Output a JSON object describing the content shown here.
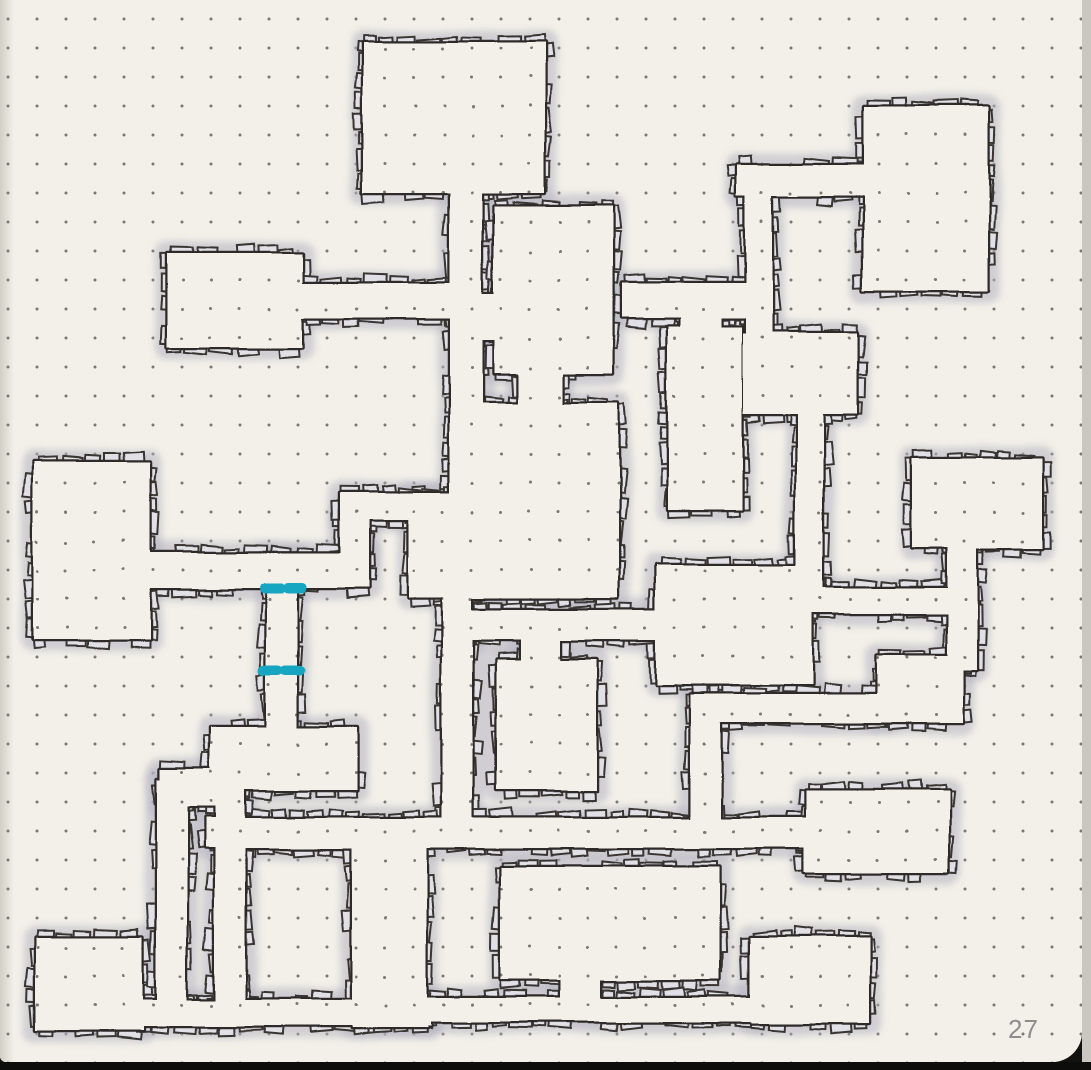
{
  "page": {
    "number": "27"
  },
  "palette": {
    "paper": "#f2f0e8",
    "dot": "#63625d",
    "ink": "#2e2c29",
    "brick_fill": "#e1e0e6",
    "brick_stroke": "#393631",
    "glow": "#b5b3c1",
    "teal_door": "#15a6c2",
    "page_number_color": "#8d8d8d"
  },
  "grid": {
    "spacing": 29,
    "offset_x": 8,
    "offset_y": 19,
    "dot_radius": 1.5
  },
  "map": {
    "shapes": [
      {
        "name": "room-top-mid",
        "x": 363,
        "y": 42,
        "w": 182,
        "h": 152
      },
      {
        "name": "corr-top-vertical",
        "x": 450,
        "y": 180,
        "w": 32,
        "h": 325
      },
      {
        "name": "room-top-left",
        "x": 167,
        "y": 253,
        "w": 135,
        "h": 95
      },
      {
        "name": "corr-topleft-east",
        "x": 290,
        "y": 283,
        "w": 172,
        "h": 35
      },
      {
        "name": "room-center-top",
        "x": 494,
        "y": 207,
        "w": 119,
        "h": 166
      },
      {
        "name": "conn-vert-centertop",
        "x": 470,
        "y": 295,
        "w": 36,
        "h": 45
      },
      {
        "name": "conn-centertop-center",
        "x": 518,
        "y": 360,
        "w": 44,
        "h": 55
      },
      {
        "name": "room-center-east",
        "x": 478,
        "y": 403,
        "w": 140,
        "h": 195
      },
      {
        "name": "room-center-west",
        "x": 408,
        "y": 493,
        "w": 80,
        "h": 105
      },
      {
        "name": "corr-west-east",
        "x": 138,
        "y": 553,
        "w": 230,
        "h": 35
      },
      {
        "name": "conn-west-jog",
        "x": 340,
        "y": 510,
        "w": 28,
        "h": 55
      },
      {
        "name": "corr-west-upper",
        "x": 340,
        "y": 493,
        "w": 142,
        "h": 27
      },
      {
        "name": "room-left-big",
        "x": 33,
        "y": 462,
        "w": 117,
        "h": 178
      },
      {
        "name": "corr-teal-vertical",
        "x": 266,
        "y": 553,
        "w": 32,
        "h": 187
      },
      {
        "name": "room-lowerleft-small",
        "x": 210,
        "y": 728,
        "w": 147,
        "h": 62
      },
      {
        "name": "room-top-right",
        "x": 863,
        "y": 107,
        "w": 125,
        "h": 184
      },
      {
        "name": "corr-hook-horizontal",
        "x": 737,
        "y": 165,
        "w": 140,
        "h": 31
      },
      {
        "name": "corr-hook-vertical",
        "x": 746,
        "y": 190,
        "w": 26,
        "h": 155
      },
      {
        "name": "room-inner-topright",
        "x": 743,
        "y": 333,
        "w": 114,
        "h": 81
      },
      {
        "name": "room-tall-midright",
        "x": 668,
        "y": 327,
        "w": 74,
        "h": 183
      },
      {
        "name": "corr-right-horizontal",
        "x": 622,
        "y": 283,
        "w": 138,
        "h": 35
      },
      {
        "name": "conn-tall-top",
        "x": 680,
        "y": 300,
        "w": 42,
        "h": 45
      },
      {
        "name": "room-midlow-center",
        "x": 656,
        "y": 565,
        "w": 156,
        "h": 120
      },
      {
        "name": "corr-mid-horizontal",
        "x": 455,
        "y": 610,
        "w": 215,
        "h": 30
      },
      {
        "name": "corr-center-down",
        "x": 443,
        "y": 585,
        "w": 30,
        "h": 245
      },
      {
        "name": "room-lowercenter-small",
        "x": 497,
        "y": 660,
        "w": 100,
        "h": 130
      },
      {
        "name": "conn-r15-top",
        "x": 520,
        "y": 632,
        "w": 40,
        "h": 40
      },
      {
        "name": "corr-long-h1",
        "x": 205,
        "y": 818,
        "w": 610,
        "h": 30
      },
      {
        "name": "corr-inner-down",
        "x": 797,
        "y": 405,
        "w": 26,
        "h": 195
      },
      {
        "name": "corr-east-horizontal",
        "x": 805,
        "y": 588,
        "w": 165,
        "h": 25
      },
      {
        "name": "corr-midright-down",
        "x": 948,
        "y": 540,
        "w": 29,
        "h": 130
      },
      {
        "name": "room-mid-right",
        "x": 912,
        "y": 458,
        "w": 130,
        "h": 90
      },
      {
        "name": "room-right-small",
        "x": 877,
        "y": 655,
        "w": 86,
        "h": 68
      },
      {
        "name": "corr-right-strip",
        "x": 700,
        "y": 695,
        "w": 190,
        "h": 28
      },
      {
        "name": "conn-strip-down",
        "x": 690,
        "y": 695,
        "w": 30,
        "h": 140
      },
      {
        "name": "room-east-long",
        "x": 805,
        "y": 790,
        "w": 143,
        "h": 83
      },
      {
        "name": "room-bottom-center",
        "x": 500,
        "y": 867,
        "w": 220,
        "h": 113
      },
      {
        "name": "conn-r12-down",
        "x": 560,
        "y": 960,
        "w": 40,
        "h": 55
      },
      {
        "name": "corr-bottom-h2",
        "x": 420,
        "y": 998,
        "w": 337,
        "h": 24
      },
      {
        "name": "room-bottom-right",
        "x": 750,
        "y": 937,
        "w": 120,
        "h": 86
      },
      {
        "name": "room-bottom-left",
        "x": 35,
        "y": 937,
        "w": 108,
        "h": 93
      },
      {
        "name": "corr-bottom-h3",
        "x": 135,
        "y": 1000,
        "w": 295,
        "h": 26
      },
      {
        "name": "corr-v2",
        "x": 157,
        "y": 780,
        "w": 30,
        "h": 235
      },
      {
        "name": "conn-v2-top",
        "x": 160,
        "y": 770,
        "w": 60,
        "h": 37
      },
      {
        "name": "corr-v3",
        "x": 215,
        "y": 775,
        "w": 30,
        "h": 240
      },
      {
        "name": "corr-wide-down",
        "x": 352,
        "y": 830,
        "w": 75,
        "h": 198
      }
    ],
    "doors": [
      {
        "name": "teal-door-north",
        "y": 588,
        "dashes": [
          [
            264,
            281
          ],
          [
            288,
            303
          ]
        ]
      },
      {
        "name": "teal-door-south",
        "y": 672,
        "dashes": [
          [
            263,
            279
          ],
          [
            286,
            301
          ]
        ]
      }
    ],
    "door_stroke": 10
  },
  "render": {
    "ink_width": 4.5,
    "glow_width": 24,
    "glow_opacity": 0.55,
    "brick_min_len": 11,
    "brick_max_len": 24,
    "brick_min_th": 10,
    "brick_max_th": 16,
    "seed": 7
  }
}
